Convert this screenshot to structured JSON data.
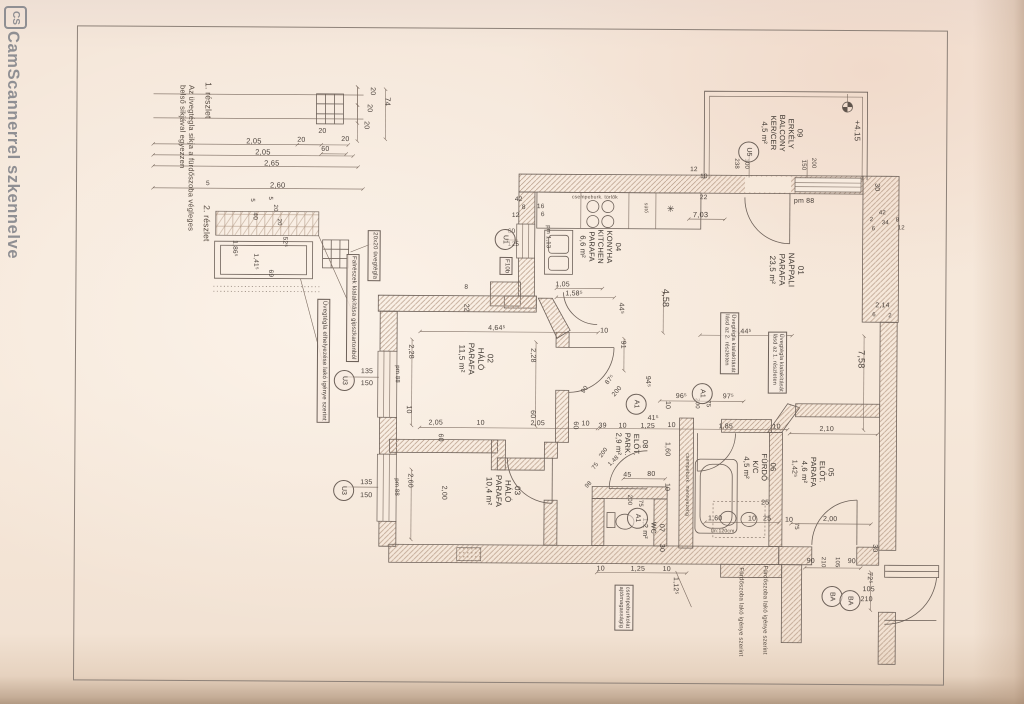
{
  "palette": {
    "paper": "#f5e7da",
    "line": "#6d6159",
    "hatch": "#b59a85",
    "text": "#4b423c",
    "watermark": "#8f8f93"
  },
  "watermark": {
    "logo_text": "CS",
    "text": "CamScannerrel szkennelve"
  },
  "plan": {
    "labels": [
      {
        "t": "1. részlet",
        "x": 202,
        "y": 84,
        "o": "v",
        "s": 8.5,
        "c": "note"
      },
      {
        "t": "Az üvegtégla sikja a fürdőszoba végleges\nbelső sikjával egyezzen",
        "x": 176,
        "y": 87,
        "o": "v",
        "s": 7.5,
        "c": "note"
      },
      {
        "t": "2. részlet",
        "x": 201,
        "y": 207,
        "o": "v",
        "s": 8.5,
        "c": "note"
      },
      {
        "t": "74",
        "x": 381,
        "y": 98,
        "o": "v",
        "s": 7.5
      },
      {
        "t": "20",
        "x": 366,
        "y": 88,
        "o": "v",
        "s": 7
      },
      {
        "t": "20",
        "x": 363,
        "y": 105,
        "o": "v",
        "s": 7
      },
      {
        "t": "20",
        "x": 360,
        "y": 122,
        "o": "v",
        "s": 7
      },
      {
        "t": "20",
        "x": 317,
        "y": 129,
        "o": "h",
        "s": 7
      },
      {
        "t": "20",
        "x": 296,
        "y": 138,
        "o": "h",
        "s": 7
      },
      {
        "t": "60",
        "x": 320,
        "y": 147,
        "o": "h",
        "s": 7
      },
      {
        "t": "20",
        "x": 340,
        "y": 137,
        "o": "h",
        "s": 7
      },
      {
        "t": "2,05",
        "x": 245,
        "y": 139,
        "o": "h",
        "s": 7.5
      },
      {
        "t": "2,05",
        "x": 254,
        "y": 150,
        "o": "h",
        "s": 7.5
      },
      {
        "t": "2,65",
        "x": 263,
        "y": 161,
        "o": "h",
        "s": 7.5
      },
      {
        "t": "5",
        "x": 205,
        "y": 182,
        "o": "h",
        "s": 6.5
      },
      {
        "t": "2,60",
        "x": 269,
        "y": 183,
        "o": "h",
        "s": 7.5
      },
      {
        "t": "5",
        "x": 247,
        "y": 200,
        "o": "v",
        "s": 6
      },
      {
        "t": "40",
        "x": 250,
        "y": 214,
        "o": "v",
        "s": 6.5
      },
      {
        "t": "5",
        "x": 265,
        "y": 198,
        "o": "v",
        "s": 6
      },
      {
        "t": "20",
        "x": 270,
        "y": 206,
        "o": "v",
        "s": 6
      },
      {
        "t": "20",
        "x": 274,
        "y": 220,
        "o": "v",
        "s": 6
      },
      {
        "t": "52⁵",
        "x": 280,
        "y": 238,
        "o": "v",
        "s": 6.5
      },
      {
        "t": "1,86⁵",
        "x": 230,
        "y": 242,
        "o": "v",
        "s": 6.5
      },
      {
        "t": "1,41⁵",
        "x": 251,
        "y": 255,
        "o": "v",
        "s": 6.5
      },
      {
        "t": "69",
        "x": 266,
        "y": 271,
        "o": "v",
        "s": 6.5
      },
      {
        "t": "20x20 üvegtégla",
        "x": 367,
        "y": 231,
        "o": "v",
        "s": 6,
        "c": "box"
      },
      {
        "t": "Falrészek kialakítása gipszkartonból",
        "x": 346,
        "y": 255,
        "o": "v",
        "s": 6,
        "c": "box"
      },
      {
        "t": "Üvegtégla elhelyezése lakó igénye szerint",
        "x": 317,
        "y": 300,
        "o": "v",
        "s": 6,
        "c": "box"
      },
      {
        "t": "135",
        "x": 361,
        "y": 369,
        "o": "h",
        "s": 7
      },
      {
        "t": "150",
        "x": 361,
        "y": 381,
        "o": "h",
        "s": 7
      },
      {
        "t": "pm 88",
        "x": 393,
        "y": 366,
        "o": "v",
        "s": 6
      },
      {
        "t": "135",
        "x": 361,
        "y": 480,
        "o": "h",
        "s": 7
      },
      {
        "t": "150",
        "x": 361,
        "y": 493,
        "o": "h",
        "s": 7
      },
      {
        "t": "pm 88",
        "x": 393,
        "y": 479,
        "o": "v",
        "s": 6
      },
      {
        "t": "42",
        "x": 514,
        "y": 196,
        "o": "h",
        "s": 6.5
      },
      {
        "t": "8",
        "x": 521,
        "y": 204,
        "o": "h",
        "s": 6.5
      },
      {
        "t": "12",
        "x": 511,
        "y": 212,
        "o": "h",
        "s": 6.5
      },
      {
        "t": "16",
        "x": 536,
        "y": 203,
        "o": "h",
        "s": 6.5
      },
      {
        "t": "6",
        "x": 540,
        "y": 211,
        "o": "h",
        "s": 6.5
      },
      {
        "t": "csempeburk. törlők",
        "x": 571,
        "y": 195,
        "o": "h",
        "s": 5,
        "c": "note"
      },
      {
        "t": "sütő",
        "x": 641,
        "y": 202,
        "o": "v",
        "s": 5,
        "c": "note"
      },
      {
        "t": "✳",
        "x": 666,
        "y": 203,
        "o": "h",
        "s": 9
      },
      {
        "t": "pm 1,13",
        "x": 543,
        "y": 225,
        "o": "v",
        "s": 6
      },
      {
        "t": "60",
        "x": 507,
        "y": 228,
        "o": "h",
        "s": 6.5
      },
      {
        "t": "125",
        "x": 507,
        "y": 241,
        "o": "h",
        "s": 6.5
      },
      {
        "t": "F10b",
        "x": 499,
        "y": 257,
        "o": "v",
        "s": 6,
        "c": "box"
      },
      {
        "t": "04\nKONYHA\nKITCHEN\nPARAFA\n6,6 m²",
        "x": 577,
        "y": 229,
        "o": "v",
        "s": 7.5,
        "c": "room"
      },
      {
        "t": "1,05",
        "x": 555,
        "y": 281,
        "o": "h",
        "s": 7
      },
      {
        "t": "1,58⁵",
        "x": 565,
        "y": 290,
        "o": "h",
        "s": 7
      },
      {
        "t": "44⁵",
        "x": 616,
        "y": 302,
        "o": "v",
        "s": 7
      },
      {
        "t": "4,58",
        "x": 660,
        "y": 288,
        "o": "v",
        "s": 9
      },
      {
        "t": "12",
        "x": 689,
        "y": 165,
        "o": "h",
        "s": 6.5
      },
      {
        "t": "10",
        "x": 699,
        "y": 172,
        "o": "h",
        "s": 6.5
      },
      {
        "t": "22",
        "x": 699,
        "y": 193,
        "o": "h",
        "s": 6.5
      },
      {
        "t": "7,03",
        "x": 692,
        "y": 210,
        "o": "h",
        "s": 7.5
      },
      {
        "t": "09\nERKÉLY\nBALCONY\nKER/CER\n4,5 m²",
        "x": 758,
        "y": 113,
        "o": "v",
        "s": 7.5,
        "c": "room"
      },
      {
        "t": "238",
        "x": 731,
        "y": 157,
        "o": "v",
        "s": 6
      },
      {
        "t": "100",
        "x": 741,
        "y": 157,
        "o": "v",
        "s": 6
      },
      {
        "t": "150",
        "x": 798,
        "y": 158,
        "o": "v",
        "s": 6
      },
      {
        "t": "200",
        "x": 808,
        "y": 156,
        "o": "v",
        "s": 6
      },
      {
        "t": "+4.15",
        "x": 851,
        "y": 118,
        "o": "v",
        "s": 8
      },
      {
        "t": "pm 88",
        "x": 793,
        "y": 196,
        "o": "h",
        "s": 7
      },
      {
        "t": "30",
        "x": 871,
        "y": 181,
        "o": "v",
        "s": 7
      },
      {
        "t": "2",
        "x": 869,
        "y": 215,
        "o": "h",
        "s": 6
      },
      {
        "t": "42",
        "x": 878,
        "y": 208,
        "o": "h",
        "s": 6
      },
      {
        "t": "8",
        "x": 895,
        "y": 215,
        "o": "h",
        "s": 6
      },
      {
        "t": "6",
        "x": 871,
        "y": 224,
        "o": "h",
        "s": 6
      },
      {
        "t": "34",
        "x": 881,
        "y": 218,
        "o": "h",
        "s": 6
      },
      {
        "t": "12",
        "x": 897,
        "y": 223,
        "o": "h",
        "s": 6
      },
      {
        "t": "2,14",
        "x": 875,
        "y": 300,
        "o": "h",
        "s": 7
      },
      {
        "t": "6",
        "x": 872,
        "y": 310,
        "o": "h",
        "s": 6
      },
      {
        "t": "2",
        "x": 888,
        "y": 311,
        "o": "h",
        "s": 6
      },
      {
        "t": "01\nNAPPALI\nPARAFA\n23,5 m²",
        "x": 767,
        "y": 251,
        "o": "v",
        "s": 8,
        "c": "room"
      },
      {
        "t": "5,44⁵",
        "x": 734,
        "y": 327,
        "o": "h",
        "s": 7
      },
      {
        "t": "7,58",
        "x": 856,
        "y": 348,
        "o": "v",
        "s": 9
      },
      {
        "t": "Üvegtégla kialakítását\nlásd az 2. részleten",
        "x": 720,
        "y": 311,
        "o": "v",
        "s": 5.5,
        "c": "box"
      },
      {
        "t": "Üvegtégla kialakítását\nlásd az 1. részleten",
        "x": 768,
        "y": 330,
        "o": "v",
        "s": 5.5,
        "c": "box"
      },
      {
        "t": "8",
        "x": 464,
        "y": 284,
        "o": "h",
        "s": 6.5
      },
      {
        "t": "22",
        "x": 461,
        "y": 304,
        "o": "v",
        "s": 7
      },
      {
        "t": "2,28",
        "x": 406,
        "y": 345,
        "o": "v",
        "s": 7
      },
      {
        "t": "02\nHÁLÓ\nPARAFA\n11,5 m²",
        "x": 457,
        "y": 343,
        "o": "v",
        "s": 8,
        "c": "room"
      },
      {
        "t": "2,28",
        "x": 528,
        "y": 348,
        "o": "v",
        "s": 7
      },
      {
        "t": "4,64⁵",
        "x": 488,
        "y": 325,
        "o": "h",
        "s": 7
      },
      {
        "t": "10",
        "x": 600,
        "y": 327,
        "o": "h",
        "s": 7
      },
      {
        "t": "91",
        "x": 618,
        "y": 340,
        "o": "v",
        "s": 7
      },
      {
        "t": "10",
        "x": 404,
        "y": 406,
        "o": "v",
        "s": 7
      },
      {
        "t": "2,05",
        "x": 429,
        "y": 420,
        "o": "h",
        "s": 7
      },
      {
        "t": "10",
        "x": 477,
        "y": 420,
        "o": "h",
        "s": 7
      },
      {
        "t": "2,05",
        "x": 531,
        "y": 420,
        "o": "h",
        "s": 7
      },
      {
        "t": "60",
        "x": 436,
        "y": 434,
        "o": "v",
        "s": 7
      },
      {
        "t": "60",
        "x": 528,
        "y": 410,
        "o": "v",
        "s": 7
      },
      {
        "t": "10",
        "x": 582,
        "y": 420,
        "o": "h",
        "s": 7
      },
      {
        "t": "2,60",
        "x": 406,
        "y": 474,
        "o": "v",
        "s": 7
      },
      {
        "t": "2,00",
        "x": 440,
        "y": 486,
        "o": "v",
        "s": 7
      },
      {
        "t": "03\nHÁLÓ\nPARAFA\n10,4 m²",
        "x": 485,
        "y": 475,
        "o": "v",
        "s": 8,
        "c": "room"
      },
      {
        "t": "94⁵",
        "x": 643,
        "y": 375,
        "o": "v",
        "s": 7
      },
      {
        "t": "87⁵",
        "x": 604,
        "y": 381,
        "o": "h",
        "s": 6.5,
        "d": -50
      },
      {
        "t": "200",
        "x": 611,
        "y": 393,
        "o": "h",
        "s": 6.5,
        "d": -50
      },
      {
        "t": "90",
        "x": 580,
        "y": 390,
        "o": "h",
        "s": 6.5,
        "d": -50
      },
      {
        "t": "96⁵",
        "x": 676,
        "y": 392,
        "o": "h",
        "s": 7
      },
      {
        "t": "200",
        "x": 693,
        "y": 397,
        "o": "v",
        "s": 6
      },
      {
        "t": "75",
        "x": 704,
        "y": 399,
        "o": "v",
        "s": 6
      },
      {
        "t": "97⁵",
        "x": 723,
        "y": 392,
        "o": "h",
        "s": 7
      },
      {
        "t": "10",
        "x": 663,
        "y": 400,
        "o": "v",
        "s": 7
      },
      {
        "t": "41⁵",
        "x": 648,
        "y": 414,
        "o": "h",
        "s": 7
      },
      {
        "t": "1,25",
        "x": 641,
        "y": 422,
        "o": "h",
        "s": 7
      },
      {
        "t": "10",
        "x": 668,
        "y": 421,
        "o": "h",
        "s": 7
      },
      {
        "t": "39",
        "x": 599,
        "y": 422,
        "o": "h",
        "s": 7
      },
      {
        "t": "10",
        "x": 619,
        "y": 422,
        "o": "h",
        "s": 7
      },
      {
        "t": "60",
        "x": 571,
        "y": 421,
        "o": "v",
        "s": 7
      },
      {
        "t": "1,85",
        "x": 719,
        "y": 422,
        "o": "h",
        "s": 7
      },
      {
        "t": "10",
        "x": 773,
        "y": 422,
        "o": "h",
        "s": 7
      },
      {
        "t": "2,10",
        "x": 820,
        "y": 424,
        "o": "h",
        "s": 7
      },
      {
        "t": "08\nELŐT.\nPARK.\n2,9 m²",
        "x": 614,
        "y": 432,
        "o": "v",
        "s": 7.5,
        "c": "room"
      },
      {
        "t": "1,60",
        "x": 663,
        "y": 441,
        "o": "v",
        "s": 7
      },
      {
        "t": "1,48",
        "x": 608,
        "y": 463,
        "o": "h",
        "s": 6,
        "d": -45
      },
      {
        "t": "45",
        "x": 624,
        "y": 471,
        "o": "h",
        "s": 7
      },
      {
        "t": "80",
        "x": 648,
        "y": 470,
        "o": "h",
        "s": 7
      },
      {
        "t": "10",
        "x": 663,
        "y": 482,
        "o": "v",
        "s": 7
      },
      {
        "t": "200",
        "x": 626,
        "y": 494,
        "o": "v",
        "s": 6
      },
      {
        "t": "75",
        "x": 637,
        "y": 499,
        "o": "v",
        "s": 6
      },
      {
        "t": "07\nWC\n1,2 m²",
        "x": 641,
        "y": 517,
        "o": "v",
        "s": 7,
        "c": "room"
      },
      {
        "t": "98",
        "x": 585,
        "y": 485,
        "o": "h",
        "s": 6,
        "d": -45
      },
      {
        "t": "200",
        "x": 599,
        "y": 455,
        "o": "h",
        "s": 6,
        "d": -55
      },
      {
        "t": "75",
        "x": 592,
        "y": 467,
        "o": "h",
        "s": 6,
        "d": -55
      },
      {
        "t": "06\nFÜRDŐ\nK/C\n4,5 m²",
        "x": 742,
        "y": 452,
        "o": "v",
        "s": 7.5,
        "c": "room"
      },
      {
        "t": "csempeburk. mennyezetig",
        "x": 684,
        "y": 452,
        "o": "v",
        "s": 5,
        "c": "note"
      },
      {
        "t": "25",
        "x": 762,
        "y": 498,
        "o": "h",
        "s": 7
      },
      {
        "t": "1,60",
        "x": 709,
        "y": 514,
        "o": "h",
        "s": 7
      },
      {
        "t": "10",
        "x": 749,
        "y": 514,
        "o": "h",
        "s": 7
      },
      {
        "t": "25",
        "x": 764,
        "y": 514,
        "o": "h",
        "s": 7
      },
      {
        "t": "tm:120cm",
        "x": 712,
        "y": 528,
        "o": "h",
        "s": 5,
        "c": "note"
      },
      {
        "t": "1,42⁵",
        "x": 790,
        "y": 458,
        "o": "v",
        "s": 7
      },
      {
        "t": "05\nELŐT.\nPARAFA\n4,6 m²",
        "x": 800,
        "y": 455,
        "o": "v",
        "s": 7.5,
        "c": "room"
      },
      {
        "t": "2,00",
        "x": 824,
        "y": 514,
        "o": "h",
        "s": 7
      },
      {
        "t": "10",
        "x": 786,
        "y": 515,
        "o": "h",
        "s": 7
      },
      {
        "t": "75",
        "x": 793,
        "y": 521,
        "o": "v",
        "s": 6
      },
      {
        "t": "30",
        "x": 871,
        "y": 542,
        "o": "v",
        "s": 7
      },
      {
        "t": "90",
        "x": 808,
        "y": 556,
        "o": "h",
        "s": 7
      },
      {
        "t": "210",
        "x": 820,
        "y": 555,
        "o": "v",
        "s": 6
      },
      {
        "t": "105",
        "x": 834,
        "y": 555,
        "o": "v",
        "s": 6
      },
      {
        "t": "90",
        "x": 849,
        "y": 556,
        "o": "h",
        "s": 7
      },
      {
        "t": "72⁵",
        "x": 866,
        "y": 570,
        "o": "v",
        "s": 7
      },
      {
        "t": "105",
        "x": 864,
        "y": 584,
        "o": "h",
        "s": 7
      },
      {
        "t": "210",
        "x": 862,
        "y": 594,
        "o": "h",
        "s": 7
      },
      {
        "t": "30",
        "x": 658,
        "y": 543,
        "o": "v",
        "s": 7
      },
      {
        "t": "10",
        "x": 598,
        "y": 565,
        "o": "h",
        "s": 7
      },
      {
        "t": "1,25",
        "x": 632,
        "y": 565,
        "o": "h",
        "s": 7
      },
      {
        "t": "10",
        "x": 664,
        "y": 565,
        "o": "h",
        "s": 7
      },
      {
        "t": "1,12⁵",
        "x": 672,
        "y": 576,
        "o": "v",
        "s": 7
      },
      {
        "t": "csempeburkolat\najtómagasságig",
        "x": 616,
        "y": 584,
        "o": "v",
        "s": 5.5,
        "c": "box"
      },
      {
        "t": "Fürdőszoba lakó igénye szerint",
        "x": 762,
        "y": 564,
        "o": "v",
        "s": 6,
        "c": "note"
      },
      {
        "t": "Fürdőszoba lakó igénye szerint",
        "x": 738,
        "y": 566,
        "o": "v",
        "s": 6,
        "c": "note"
      }
    ],
    "markers": [
      {
        "t": "U3",
        "x": 334,
        "y": 371
      },
      {
        "t": "U3",
        "x": 334,
        "y": 481
      },
      {
        "t": "U1",
        "x": 494,
        "y": 229
      },
      {
        "t": "U5",
        "x": 737,
        "y": 140
      },
      {
        "t": "A1",
        "x": 692,
        "y": 382
      },
      {
        "t": "A1",
        "x": 626,
        "y": 393
      },
      {
        "t": "A1",
        "x": 628,
        "y": 507
      },
      {
        "t": "BA",
        "x": 823,
        "y": 584
      },
      {
        "t": "BA",
        "x": 841,
        "y": 588
      }
    ]
  }
}
